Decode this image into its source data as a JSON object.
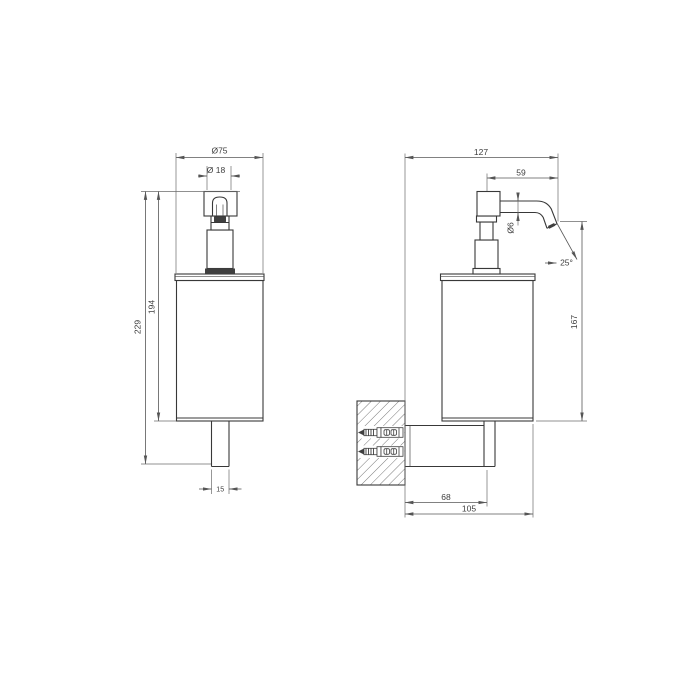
{
  "drawing": {
    "type": "technical-dimension-drawing",
    "subject": "wall-mounted soap dispenser, front and side elevation",
    "colors": {
      "background": "#ffffff",
      "object_line": "#383838",
      "dimension_line": "#575757",
      "text": "#3d3d3d",
      "dark_fill": "#3f3f3f"
    },
    "views": {
      "front": {
        "dimensions": {
          "body_diameter": "Ø75",
          "pump_diameter": "Ø 18",
          "overall_height": "229",
          "body_height": "194",
          "stem_width": "15"
        }
      },
      "side": {
        "dimensions": {
          "overall_depth": "127",
          "spout_projection": "59",
          "spout_diameter": "Ø6",
          "spout_angle": "25°",
          "outlet_height": "167",
          "wall_to_bracket": "68",
          "wall_to_front": "105"
        }
      }
    }
  }
}
